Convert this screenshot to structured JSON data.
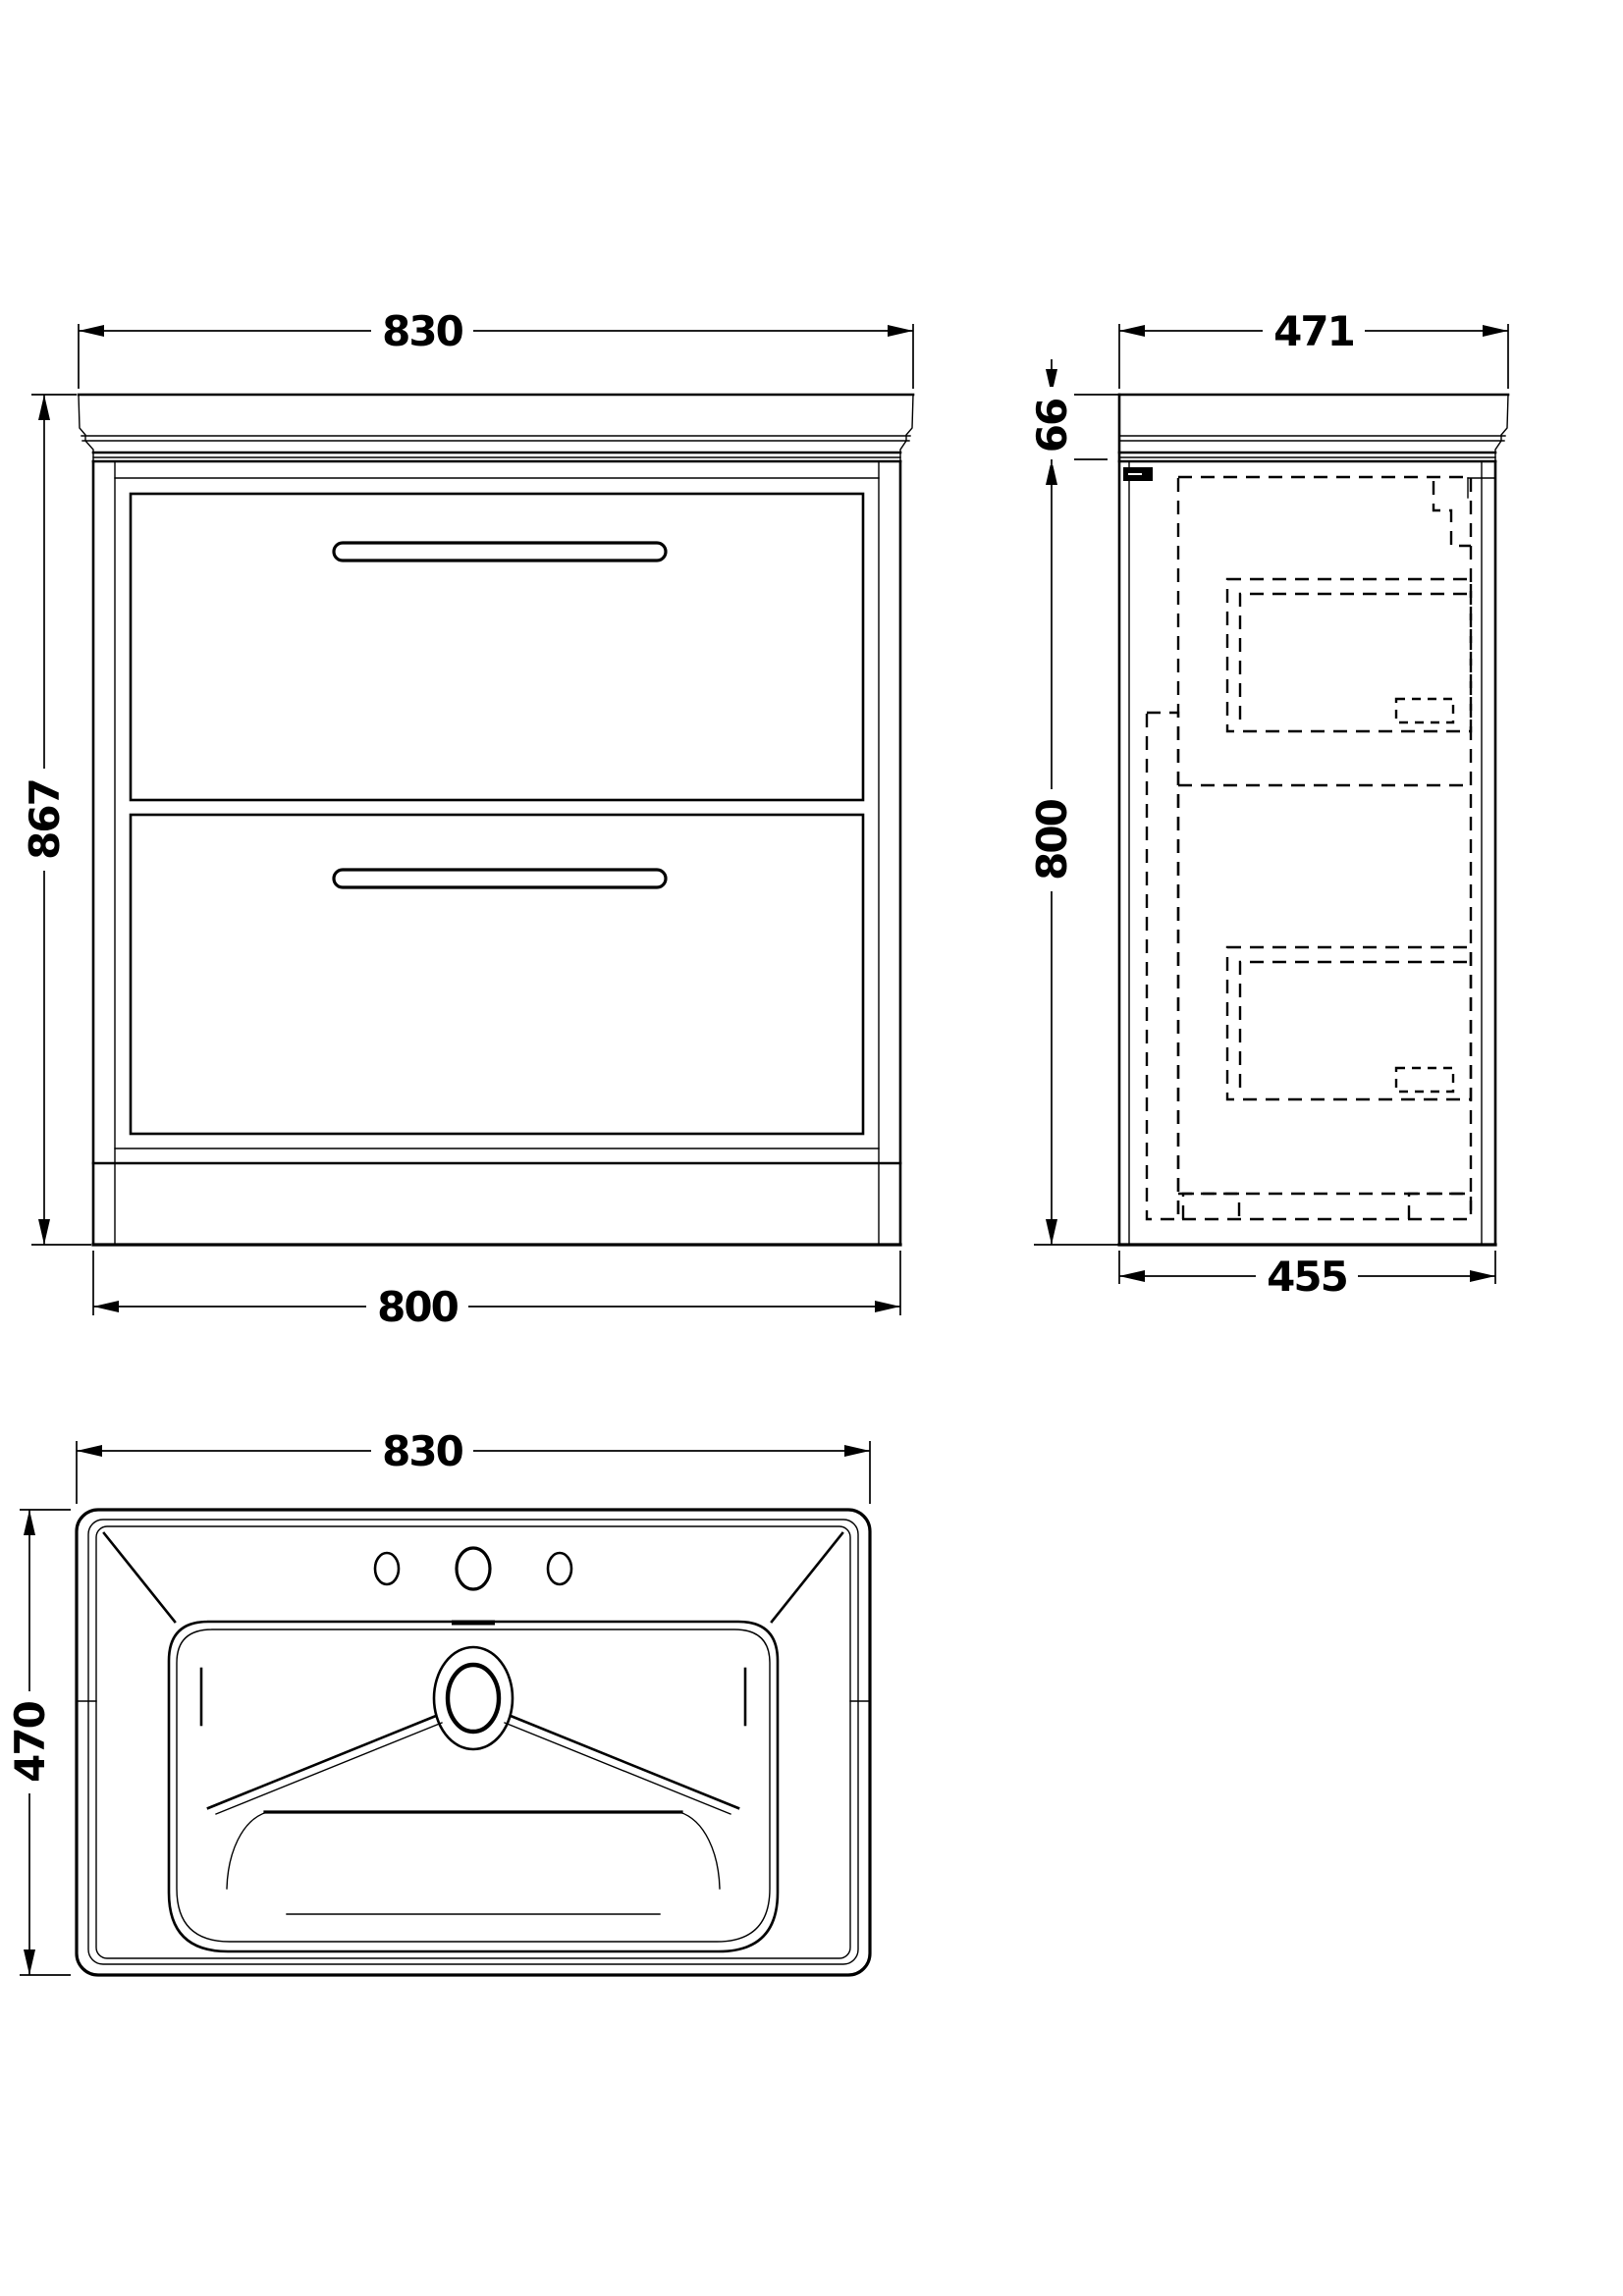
{
  "style": {
    "background": "#ffffff",
    "line_color": "#000000",
    "text_color": "#000000"
  },
  "dims": {
    "front_width_top": "830",
    "front_height": "867",
    "front_width_bottom": "800",
    "side_depth_top": "471",
    "side_worktop_height": "66",
    "side_cabinet_height": "800",
    "side_depth_bottom": "455",
    "basin_width": "830",
    "basin_depth": "470"
  }
}
